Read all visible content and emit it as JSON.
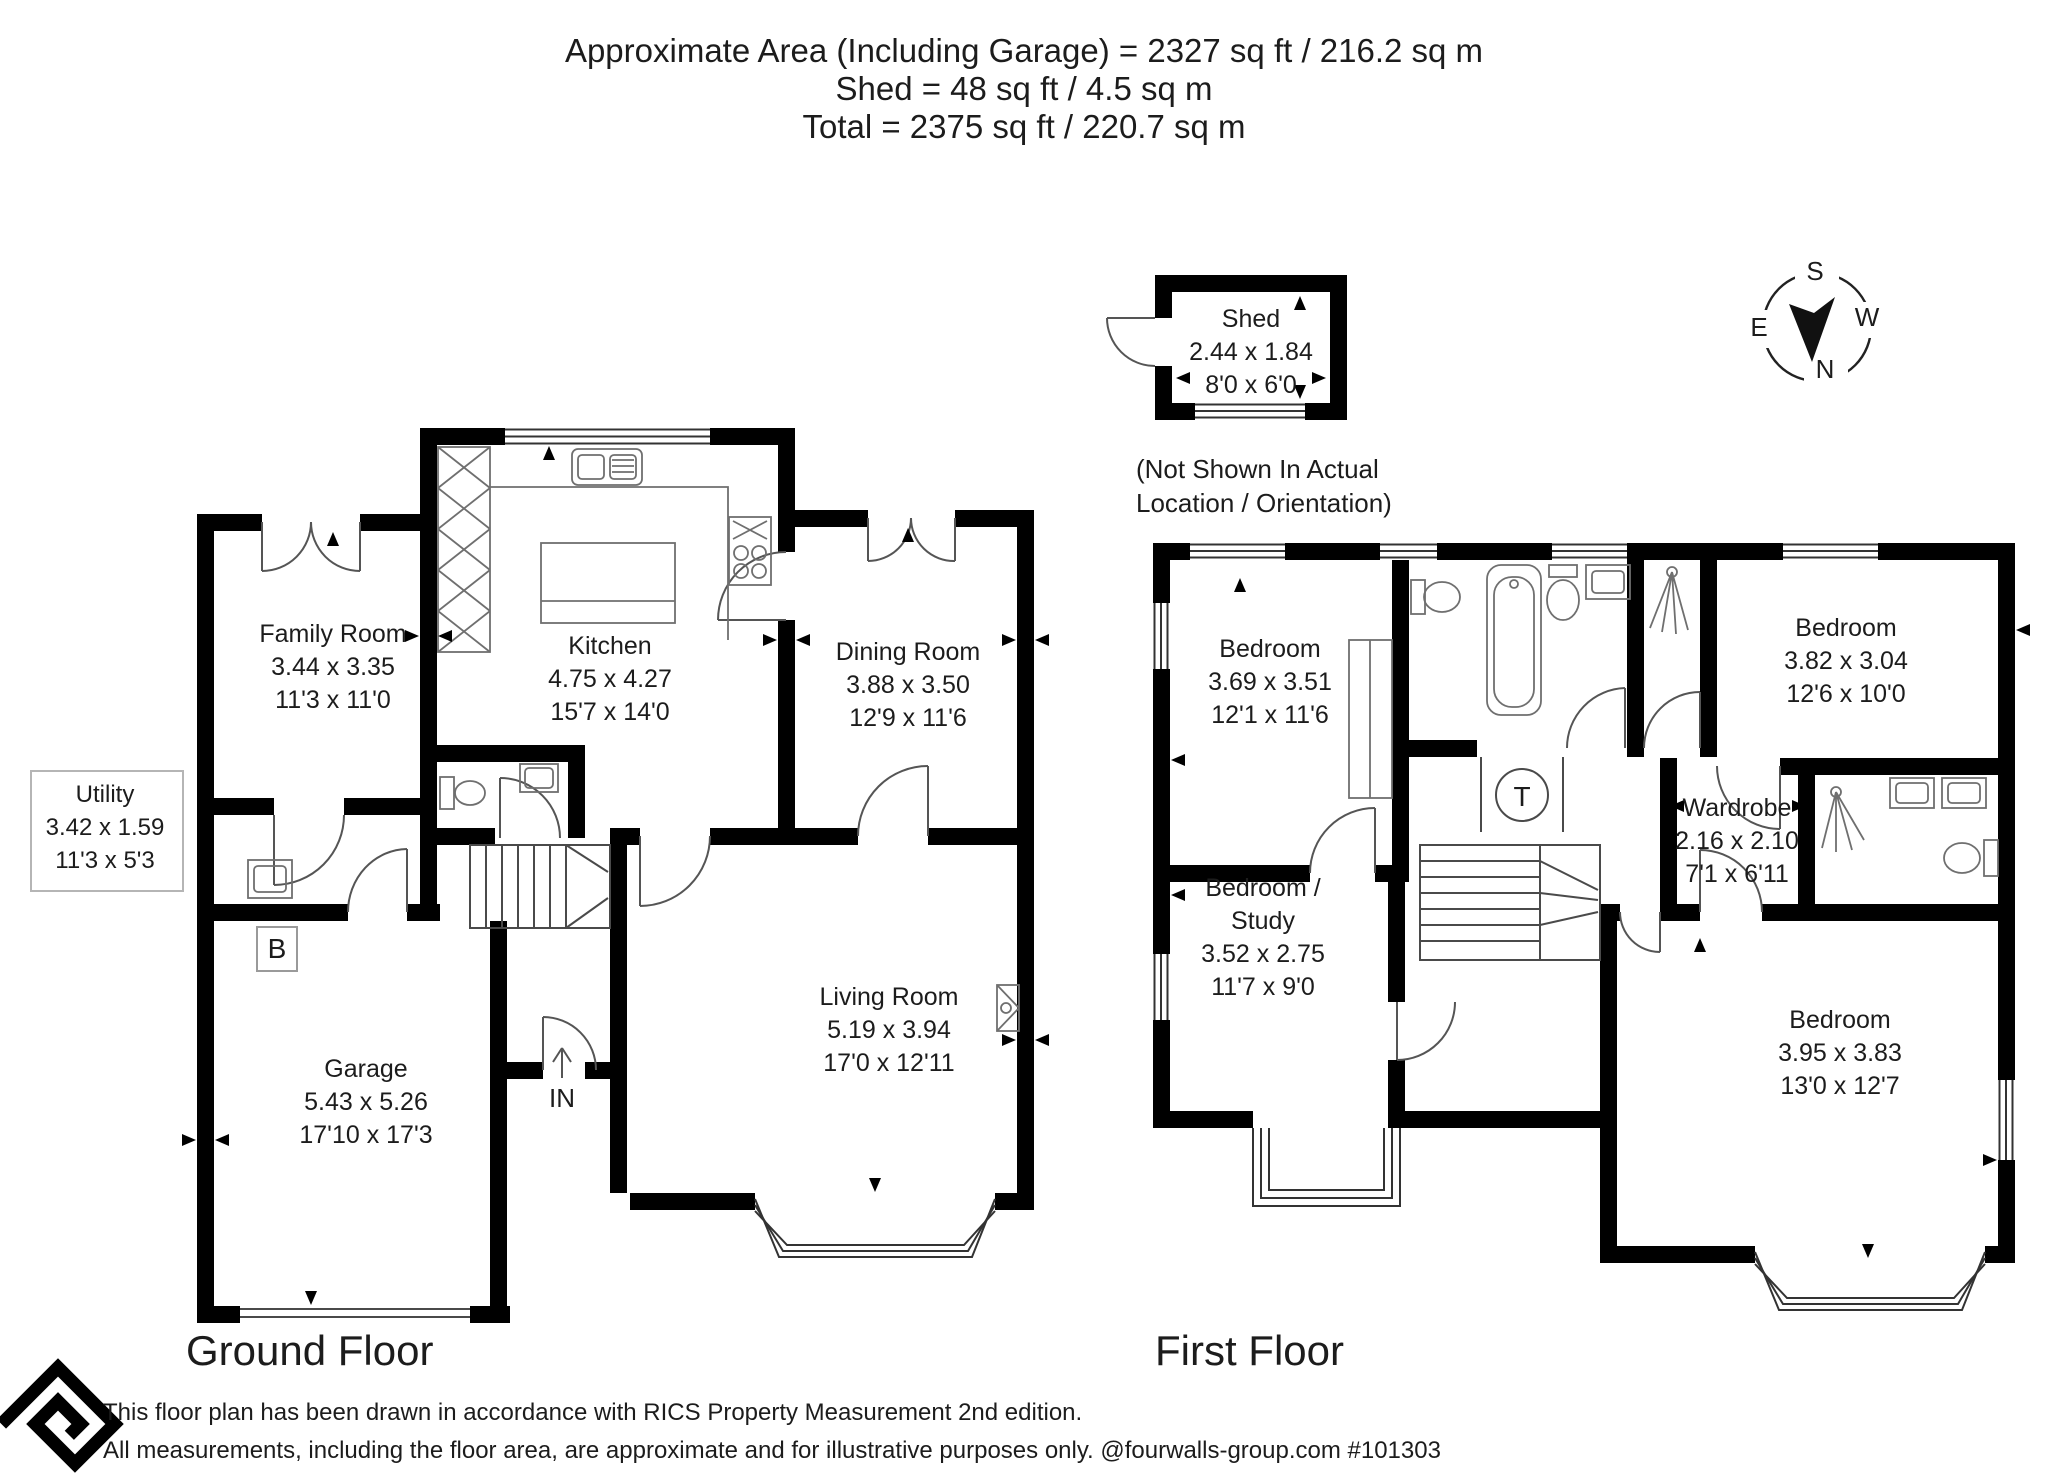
{
  "title": {
    "line1": "Approximate Area (Including Garage) = 2327 sq ft / 216.2 sq m",
    "line2": "Shed = 48 sq ft / 4.5 sq m",
    "line3": "Total = 2375 sq ft / 220.7 sq m"
  },
  "shed": {
    "name": "Shed",
    "metric": "2.44 x 1.84",
    "imperial": "8'0 x 6'0",
    "note_line1": "(Not Shown In Actual",
    "note_line2": "Location / Orientation)"
  },
  "compass": {
    "north": "N",
    "south": "S",
    "east": "E",
    "west": "W"
  },
  "floors": {
    "ground": {
      "label": "Ground Floor",
      "entrance_label": "IN",
      "boiler_label": "B",
      "rooms": {
        "family_room": {
          "name": "Family Room",
          "metric": "3.44 x 3.35",
          "imperial": "11'3 x 11'0"
        },
        "kitchen": {
          "name": "Kitchen",
          "metric": "4.75 x 4.27",
          "imperial": "15'7 x 14'0"
        },
        "dining_room": {
          "name": "Dining Room",
          "metric": "3.88 x 3.50",
          "imperial": "12'9 x 11'6"
        },
        "utility": {
          "name": "Utility",
          "metric": "3.42 x 1.59",
          "imperial": "11'3 x 5'3"
        },
        "garage": {
          "name": "Garage",
          "metric": "5.43 x 5.26",
          "imperial": "17'10 x 17'3"
        },
        "living_room": {
          "name": "Living Room",
          "metric": "5.19 x 3.94",
          "imperial": "17'0 x 12'11"
        }
      }
    },
    "first": {
      "label": "First Floor",
      "tank_label": "T",
      "rooms": {
        "bedroom1": {
          "name": "Bedroom",
          "metric": "3.69 x 3.51",
          "imperial": "12'1 x 11'6"
        },
        "bedroom2": {
          "name": "Bedroom",
          "metric": "3.82 x 3.04",
          "imperial": "12'6 x 10'0"
        },
        "wardrobe": {
          "name": "Wardrobe",
          "metric": "2.16 x 2.10",
          "imperial": "7'1 x 6'11"
        },
        "bedroom_study": {
          "name_line1": "Bedroom /",
          "name_line2": "Study",
          "metric": "3.52 x 2.75",
          "imperial": "11'7 x 9'0"
        },
        "bedroom3": {
          "name": "Bedroom",
          "metric": "3.95 x 3.83",
          "imperial": "13'0 x 12'7"
        }
      }
    }
  },
  "footer": {
    "line1": "This floor plan has been drawn in accordance with RICS Property Measurement 2nd edition.",
    "line2": "All measurements, including the floor area, are approximate and for illustrative purposes only. @fourwalls-group.com #101303"
  },
  "colors": {
    "wall": "#000000",
    "line": "#4a4a4a",
    "fixture": "#6f6f6f",
    "ink": "#1c1c1c",
    "background": "#ffffff"
  }
}
